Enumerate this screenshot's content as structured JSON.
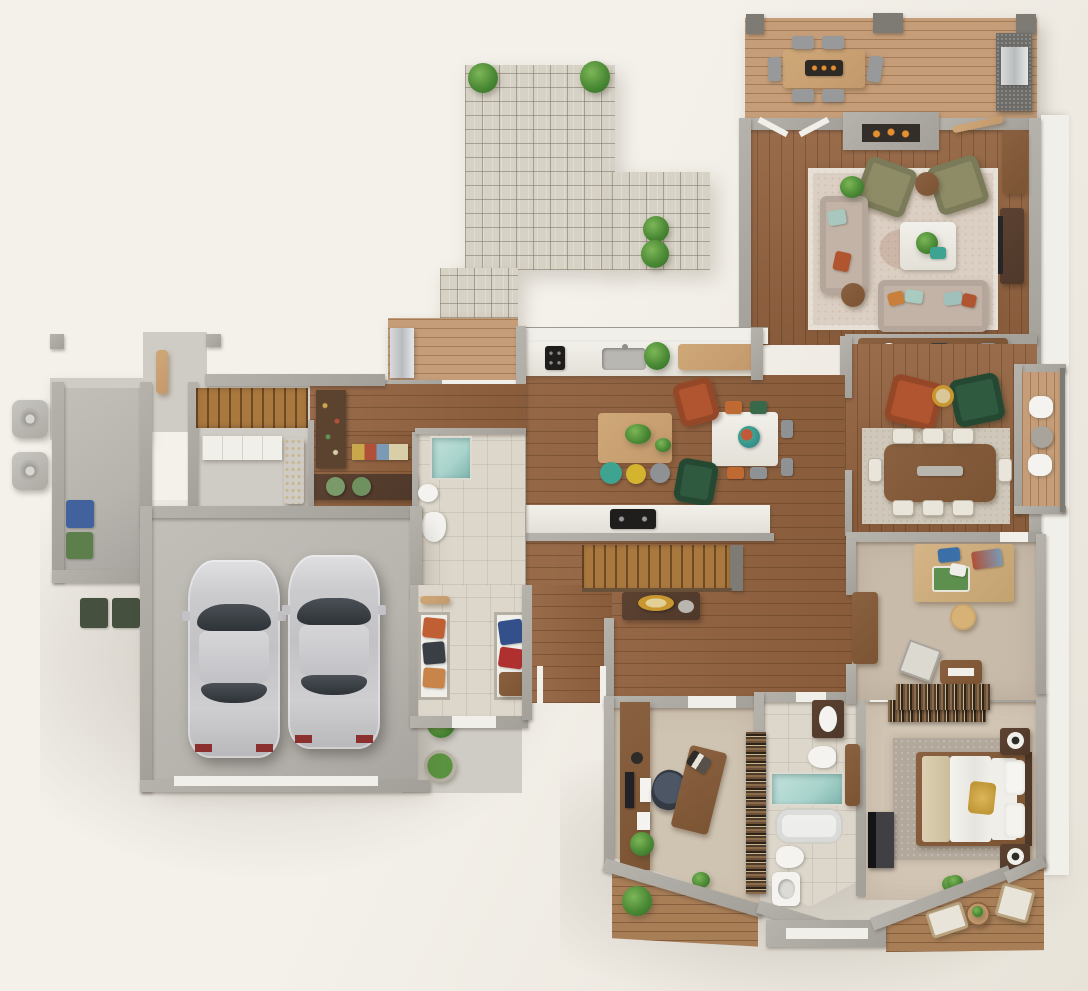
{
  "meta": {
    "type": "3d-floor-plan-render",
    "view": "top-down",
    "style": "photorealistic dollhouse render, no text labels",
    "canvas": {
      "width": 1088,
      "height": 991
    }
  },
  "palette": {
    "bg1": "#f4f1eb",
    "bg2": "#e8e3d9",
    "wall": "#a39f99",
    "wallDark": "#7e7a74",
    "white": "#f1efe9",
    "wood": "#936340",
    "deck": "#c59d78",
    "deckDark": "#a87e57",
    "walnut": "#7b5434",
    "walnutDark": "#4e382a",
    "woodLight": "#c2996c",
    "concrete": "#b7b4ae",
    "concreteLight": "#cfccc5",
    "tile": "#ddd7cb",
    "paver": "#d7d2c6",
    "carpet": "#cfc3b1",
    "carpetWarm": "#d3c6b5",
    "carpetTan": "#c8bbaa",
    "rugLiving": "#dacfc2",
    "rugDining": "#cfc8ba",
    "rugGray": "#b2a89b",
    "sofa": "#c2b3a6",
    "olive": "#8d8c66",
    "rust": "#b0552f",
    "greenChair": "#2f5a40",
    "teal": "#3fa392",
    "yellow": "#d4b42f",
    "grayChair": "#8e9295",
    "silver": "#c9c9cc",
    "blue": "#41629c",
    "binGreen": "#5d7f4c",
    "binDark": "#45513e",
    "plant": "#4b8a35",
    "plantDark": "#2f6b26",
    "fire": "#e6902f",
    "showerTeal": "#a8d3cc",
    "tubWhite": "#ececea",
    "tv": "#26262a",
    "gold": "#c9972f",
    "cork": "#c9a36a",
    "artGreen": "#5d8f4f",
    "artBlue": "#3a6fa8",
    "artRed": "#b05038"
  },
  "scene": {
    "exterior": [
      {
        "name": "paver-patio",
        "shape": "L",
        "plants": 4
      },
      {
        "name": "entry-porch",
        "items": [
          "concrete pad",
          "open wood door",
          "2 posts"
        ]
      },
      {
        "name": "side-yard",
        "items": [
          "2 hvac units",
          "bin alcove with blue bin and green bin",
          "2 dark bins"
        ]
      },
      {
        "name": "rear-deck-top",
        "items": [
          "outdoor dining table with fire tray",
          "6 chairs",
          "grill station",
          "3 posts"
        ]
      },
      {
        "name": "side-balcony-right",
        "items": [
          "3 stools"
        ]
      },
      {
        "name": "kitchen-side-deck",
        "items": [
          "outdoor fridge"
        ]
      },
      {
        "name": "bottom-deck-left",
        "items": [
          "shrubs"
        ]
      },
      {
        "name": "bottom-deck-right",
        "items": [
          "2 lounge chairs",
          "round table",
          "plant"
        ]
      },
      {
        "name": "walkway",
        "items": [
          "shrub",
          "potted plant"
        ]
      }
    ],
    "rooms": [
      {
        "name": "living-room",
        "floor": "walnut planks",
        "items": [
          "fireplace",
          "area rug",
          "2 olive armchairs",
          "round side table",
          "white coffee table with plant",
          "chaise sofa",
          "3-seat sofa with pillows",
          "sideboard",
          "tv console with tv",
          "plant stand"
        ]
      },
      {
        "name": "kitchen",
        "floor": "walnut planks",
        "items": [
          "counter with cooktop, sink, plant, cabinet",
          "island with 2 plants",
          "teal stool",
          "yellow stool",
          "gray stool",
          "peninsula counter with cooktop"
        ]
      },
      {
        "name": "casual-dining",
        "floor": "walnut planks",
        "items": [
          "white table with decorative bowl",
          "orange chairs",
          "green chairs",
          "gray chairs",
          "rust armchair",
          "green armchair"
        ]
      },
      {
        "name": "formal-dining",
        "floor": "walnut planks",
        "items": [
          "area rug",
          "walnut table with runner",
          "8 upholstered chairs",
          "rust armchair",
          "green armchair",
          "gold side table"
        ]
      },
      {
        "name": "pantry-stair-hall",
        "floor": "wood + concrete",
        "items": [
          "staircase",
          "white cabinet",
          "wine rack",
          "pantry shelves with food",
          "bench with 2 green poufs"
        ]
      },
      {
        "name": "powder-room",
        "floor": "tile",
        "items": [
          "glass shower",
          "sink",
          "toilet"
        ]
      },
      {
        "name": "garage",
        "floor": "concrete",
        "items": [
          "silver sedan",
          "silver sedan",
          "garage door threshold"
        ]
      },
      {
        "name": "mudroom",
        "floor": "tile",
        "items": [
          "coat closet with orange and dark coats",
          "closet with blue and red coats",
          "bench",
          "hook rail"
        ]
      },
      {
        "name": "stair-hall-center",
        "floor": "walnut planks",
        "items": [
          "staircase down",
          "console table with gold bowl"
        ]
      },
      {
        "name": "office",
        "floor": "carpet",
        "items": [
          "wall desk with monitor and keyboard",
          "task chair",
          "angled desk with books",
          "plant"
        ]
      },
      {
        "name": "bathroom",
        "floor": "tile",
        "items": [
          "bookshelf",
          "vanity sink",
          "toilet",
          "glass shower",
          "bathtub",
          "second toilet",
          "pedestal sink",
          "wall cabinet"
        ]
      },
      {
        "name": "bedroom",
        "floor": "carpet",
        "items": [
          "bookshelf headwall",
          "gray rug",
          "bed with white duvet, beige throw, gold pillow",
          "2 nightstands with lamps",
          "wall tv",
          "plant"
        ]
      },
      {
        "name": "craft-room",
        "floor": "carpet",
        "items": [
          "work table with paintings and supplies",
          "round stool",
          "leaning canvas",
          "record cabinet",
          "low bookshelf",
          "wardrobe"
        ]
      }
    ],
    "vehicles": [
      {
        "name": "car-left",
        "color": "silver"
      },
      {
        "name": "car-right",
        "color": "silver"
      }
    ]
  }
}
